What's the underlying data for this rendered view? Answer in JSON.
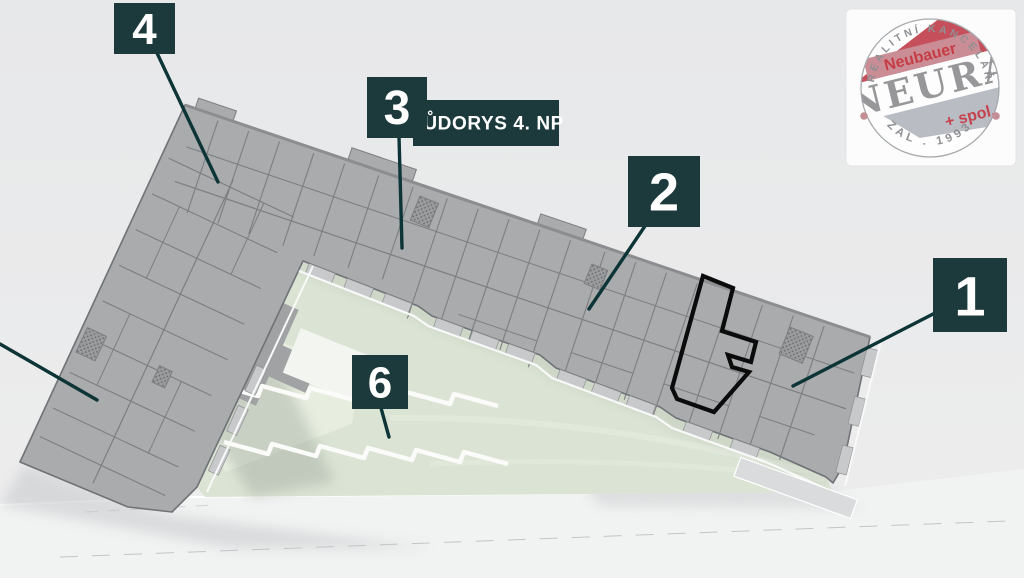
{
  "plan": {
    "plaque_title": "PŮDORYS 4. NP",
    "markers": [
      {
        "number": "4"
      },
      {
        "number": "3"
      },
      {
        "number": "2"
      },
      {
        "number": "1"
      },
      {
        "number": "6"
      }
    ]
  },
  "logo": {
    "arc_top": "REALITNÍ KANCELÁŘ",
    "name_over": "Neubauer",
    "name_main": "NEURA",
    "name_under": "+ spol.",
    "arc_bottom": "ZAL . 1993"
  },
  "colors": {
    "label_teal": "#1c393c",
    "leader_line": "#0d3436",
    "building_gray": "#a9abad",
    "wall_gray": "#7c7e81",
    "balcony_gray": "#c7c9cb",
    "courtyard_green": "#dbe4d4",
    "highlight_outline": "#0b0b0b",
    "logo_red": "#c5505b",
    "logo_pink_band": "#cb8d95",
    "logo_gray_band": "#b9bcc2",
    "background": "#e8e9ea"
  }
}
